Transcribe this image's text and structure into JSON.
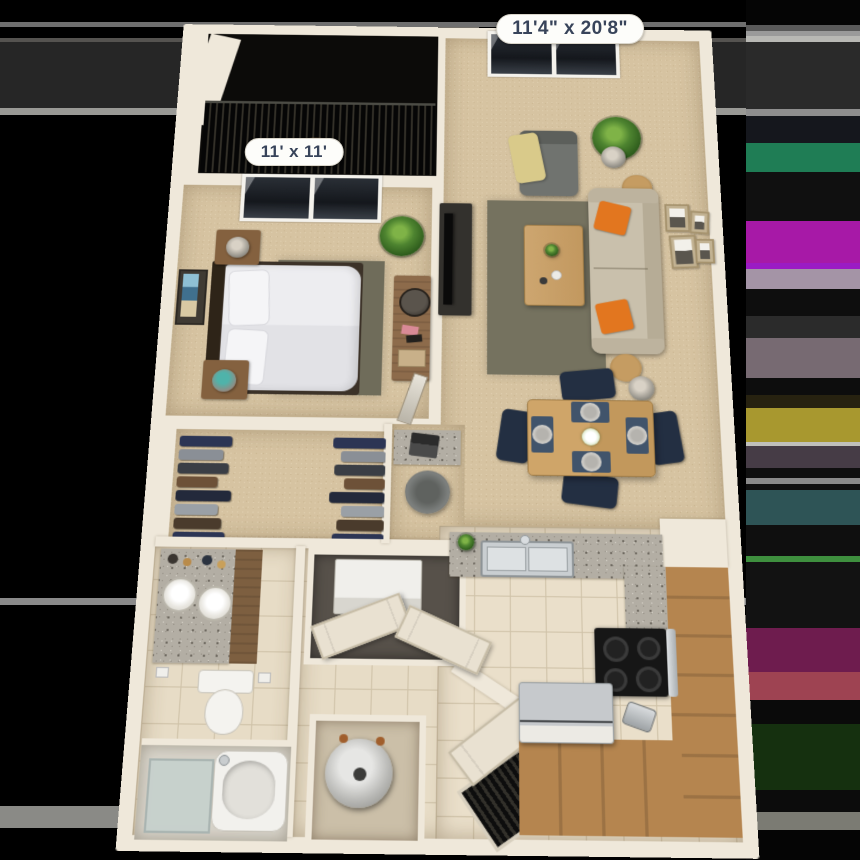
{
  "scene": {
    "kind": "3d-apartment-floorplan-render",
    "rooms_depicted": [
      "balcony",
      "bedroom",
      "walk-in-closet",
      "bathroom",
      "laundry-closet",
      "water-heater-closet",
      "living-dining-room",
      "kitchen",
      "entry"
    ]
  },
  "labels": {
    "living_dining": "11'4\" x 20'8\"",
    "bedroom": "11' x 11'"
  },
  "palette": {
    "background": "#000000",
    "wall": "#efe8da",
    "carpet": "#d6c3a1",
    "tile": "#e7dcc6",
    "granite": "#b3aea4",
    "wood_cabinet": "#b5854f",
    "accent_orange": "#e2761f",
    "sofa_beige": "#c9c0ac",
    "navy_chair": "#232f42",
    "label_bg": "#fdfdfa",
    "label_text": "#38445a"
  },
  "closet": {
    "garments": [
      {
        "color": "#2c3554",
        "w": 52
      },
      {
        "color": "#8a8f96",
        "w": 44
      },
      {
        "color": "#3a3e45",
        "w": 50
      },
      {
        "color": "#6d5138",
        "w": 40
      },
      {
        "color": "#23293b",
        "w": 54
      },
      {
        "color": "#9aa0a6",
        "w": 42
      },
      {
        "color": "#4a3b2c",
        "w": 46
      },
      {
        "color": "#2c3554",
        "w": 50
      }
    ]
  },
  "artifact_bands": {
    "right": [
      {
        "top": 0,
        "height": 25,
        "color": "#050505"
      },
      {
        "top": 25,
        "height": 6,
        "color": "#5a5a5a"
      },
      {
        "top": 31,
        "height": 5,
        "color": "#9a9a9a"
      },
      {
        "top": 36,
        "height": 6,
        "color": "#b8b8b4"
      },
      {
        "top": 42,
        "height": 67,
        "color": "#2a2a2a"
      },
      {
        "top": 109,
        "height": 7,
        "color": "#8e8e8e"
      },
      {
        "top": 116,
        "height": 27,
        "color": "#15171d"
      },
      {
        "top": 143,
        "height": 29,
        "color": "#1f7d55"
      },
      {
        "top": 172,
        "height": 49,
        "color": "#101010"
      },
      {
        "top": 221,
        "height": 42,
        "color": "#a719a7"
      },
      {
        "top": 263,
        "height": 6,
        "color": "#9b1bc4"
      },
      {
        "top": 269,
        "height": 20,
        "color": "#a494a6"
      },
      {
        "top": 289,
        "height": 27,
        "color": "#0e0e0e"
      },
      {
        "top": 316,
        "height": 22,
        "color": "#2b2b2b"
      },
      {
        "top": 338,
        "height": 40,
        "color": "#776a72"
      },
      {
        "top": 378,
        "height": 17,
        "color": "#0d0d0d"
      },
      {
        "top": 395,
        "height": 13,
        "color": "#272210"
      },
      {
        "top": 408,
        "height": 34,
        "color": "#a8982f"
      },
      {
        "top": 442,
        "height": 4,
        "color": "#c0c0bb"
      },
      {
        "top": 446,
        "height": 22,
        "color": "#463c46"
      },
      {
        "top": 468,
        "height": 10,
        "color": "#0f0f0f"
      },
      {
        "top": 478,
        "height": 6,
        "color": "#8a8a8a"
      },
      {
        "top": 484,
        "height": 6,
        "color": "#101010"
      },
      {
        "top": 490,
        "height": 35,
        "color": "#2e5456"
      },
      {
        "top": 525,
        "height": 31,
        "color": "#0f0f0f"
      },
      {
        "top": 556,
        "height": 6,
        "color": "#3e8f3e"
      },
      {
        "top": 562,
        "height": 66,
        "color": "#121212"
      },
      {
        "top": 628,
        "height": 44,
        "color": "#6e1c4e"
      },
      {
        "top": 672,
        "height": 28,
        "color": "#9e4352"
      },
      {
        "top": 700,
        "height": 24,
        "color": "#0a0a0a"
      },
      {
        "top": 724,
        "height": 66,
        "color": "#15300f"
      },
      {
        "top": 790,
        "height": 22,
        "color": "#0c0c0c"
      },
      {
        "top": 812,
        "height": 18,
        "color": "#7b7b73"
      },
      {
        "top": 830,
        "height": 30,
        "color": "#050505"
      }
    ],
    "left_lines": [
      {
        "top": 22,
        "height": 5,
        "color": "#6f6f6f"
      },
      {
        "top": 38,
        "height": 4,
        "color": "#555350"
      },
      {
        "top": 42,
        "height": 66,
        "color": "#262626"
      },
      {
        "top": 108,
        "height": 7,
        "color": "#999995"
      },
      {
        "top": 598,
        "height": 7,
        "color": "#8a8a8a"
      },
      {
        "top": 806,
        "height": 22,
        "color": "#8a8a86"
      }
    ]
  }
}
